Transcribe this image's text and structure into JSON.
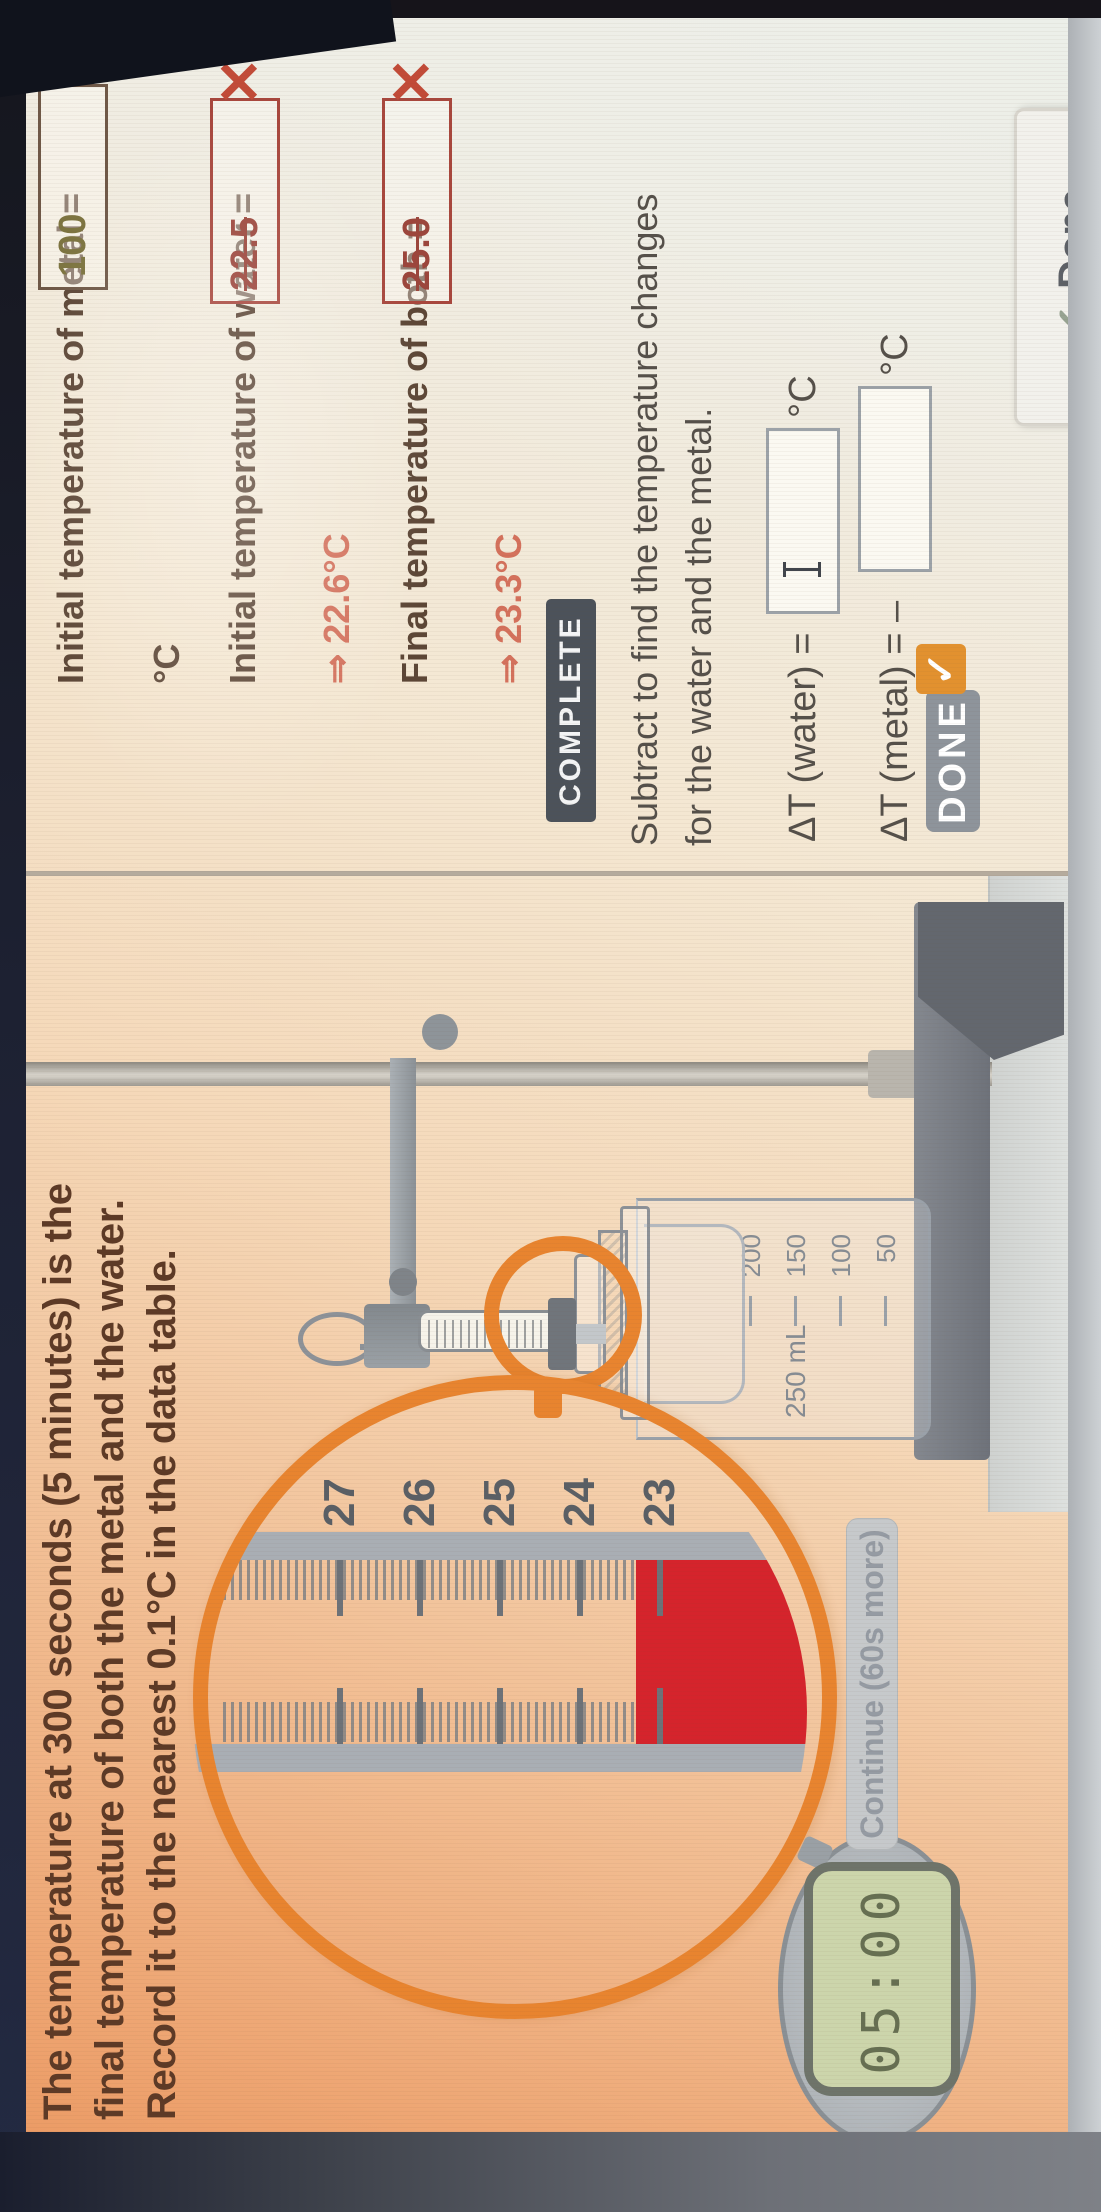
{
  "instructions": {
    "line1": "The temperature at 300 seconds (5 minutes) is the",
    "line2": "final temperature of both the metal and the water.",
    "line3": "Record it to the nearest 0.1°C in the data table."
  },
  "panel": {
    "questions": [
      {
        "label": "Initial temperature of metal =",
        "value": "100",
        "unit": "°C",
        "mark": "✓"
      },
      {
        "label": "Initial temperature of water =",
        "value": "22.5",
        "result": "⇒ 22.6°C",
        "mark": "✕"
      },
      {
        "label": "Final temperature of both =",
        "value": "25.0",
        "result": "⇒ 23.3°C",
        "mark": "✕"
      }
    ],
    "complete_badge": "COMPLETE",
    "subtract_line1": "Subtract to find the temperature changes",
    "subtract_line2": "for the water and the metal.",
    "dt_water_label": "ΔT (water) =",
    "dt_water_unit": "°C",
    "dt_metal_label": "ΔT (metal) = –",
    "dt_metal_unit": "°C",
    "done_button": "DONE",
    "done_button_check": "✓"
  },
  "sim": {
    "timer": "05:00",
    "continue_button": "Continue (60s more)",
    "beaker_label": "250 mL",
    "beaker_graduations": [
      "200",
      "150",
      "100",
      "50"
    ],
    "thermometer_scale": [
      "27",
      "26",
      "25",
      "24",
      "23"
    ],
    "magnified_reading_c": 23.3
  },
  "footer": {
    "check": "✓",
    "done_label": "Done"
  },
  "colors": {
    "accent_orange": "#e8842f",
    "mercury_red": "#d5242c",
    "error_red": "#c24b38",
    "success_check": "#72735c",
    "value_olive": "#7d7440"
  }
}
